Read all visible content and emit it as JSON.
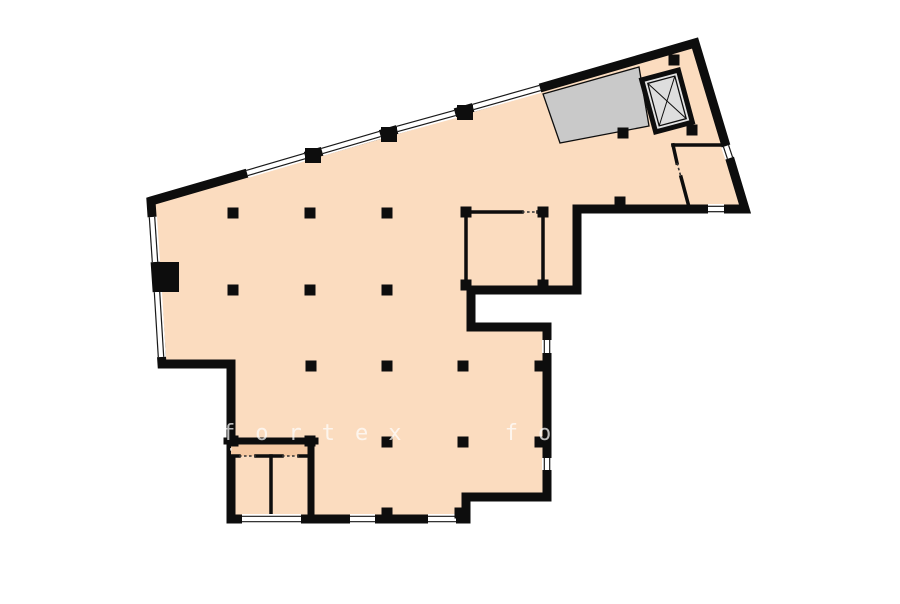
{
  "watermark": {
    "text": "fortex fortex",
    "color": "#ffffff",
    "opacity": 0.72
  },
  "plan": {
    "background_color": "#ffffff",
    "wall_color": "#0d0d0d",
    "floor_color": "#fbdcbf",
    "vestibule_color": "#f5c9a3",
    "stair_color": "#c9c9c9",
    "elevator_fill": "#e3e3e3",
    "elevator_cab_fill": "#dedede",
    "outline_width": 9,
    "outline": [
      [
        151,
        201
      ],
      [
        695,
        43
      ],
      [
        745,
        209
      ],
      [
        577,
        209
      ],
      [
        577,
        290
      ],
      [
        471,
        290
      ],
      [
        471,
        327
      ],
      [
        547,
        327
      ],
      [
        547,
        497
      ],
      [
        466,
        497
      ],
      [
        466,
        519
      ],
      [
        231,
        519
      ],
      [
        231,
        364
      ],
      [
        162,
        364
      ]
    ],
    "windows": [
      [
        247,
        173,
        305,
        156
      ],
      [
        322,
        151,
        380,
        134
      ],
      [
        397,
        129,
        455,
        113
      ],
      [
        473,
        107,
        540,
        88
      ],
      [
        152,
        217,
        155,
        262
      ],
      [
        157,
        292,
        161,
        357
      ],
      [
        242,
        519,
        301,
        519
      ],
      [
        350,
        519,
        375,
        519
      ],
      [
        428,
        519,
        456,
        519
      ],
      [
        547,
        340,
        547,
        353
      ],
      [
        547,
        458,
        547,
        470
      ],
      [
        708,
        209,
        724,
        209
      ],
      [
        726,
        146,
        730,
        158
      ]
    ],
    "inner_walls": [
      {
        "a": [
          466,
          212
        ],
        "b": [
          466,
          285
        ],
        "w": 3.5
      },
      {
        "a": [
          543,
          212
        ],
        "b": [
          543,
          285
        ],
        "w": 3.5
      },
      {
        "a": [
          466,
          212
        ],
        "b": [
          522,
          212
        ],
        "w": 3.5
      },
      {
        "a": [
          538,
          212
        ],
        "b": [
          543,
          212
        ],
        "w": 3.5
      },
      {
        "a": [
          673,
          145
        ],
        "b": [
          726,
          145
        ],
        "w": 3.5
      },
      {
        "a": [
          673,
          145
        ],
        "b": [
          677,
          163
        ],
        "w": 3.5
      },
      {
        "a": [
          681,
          177
        ],
        "b": [
          689,
          207
        ],
        "w": 3.5
      },
      {
        "a": [
          231,
          456
        ],
        "b": [
          239,
          456
        ],
        "w": 3.5
      },
      {
        "a": [
          256,
          456
        ],
        "b": [
          282,
          456
        ],
        "w": 3.5
      },
      {
        "a": [
          299,
          456
        ],
        "b": [
          311,
          456
        ],
        "w": 3.5
      },
      {
        "a": [
          271,
          456
        ],
        "b": [
          271,
          519
        ],
        "w": 3.5
      },
      {
        "a": [
          227,
          441
        ],
        "b": [
          315,
          441
        ],
        "w": 7
      },
      {
        "a": [
          311,
          441
        ],
        "b": [
          311,
          519
        ],
        "w": 7
      }
    ],
    "door_openings": [
      {
        "seg": [
          522,
          212,
          538,
          212
        ],
        "light": false
      },
      {
        "seg": [
          677,
          163,
          681,
          177
        ],
        "light": false
      },
      {
        "seg": [
          239,
          456,
          256,
          456
        ],
        "light": false
      },
      {
        "seg": [
          282,
          456,
          299,
          456
        ],
        "light": false
      },
      {
        "seg": [
          231,
          443,
          231,
          453
        ],
        "light": true
      }
    ],
    "columns": [
      [
        233,
        213
      ],
      [
        310,
        213
      ],
      [
        387,
        213
      ],
      [
        233,
        290
      ],
      [
        310,
        290
      ],
      [
        387,
        290
      ],
      [
        311,
        366
      ],
      [
        387,
        366
      ],
      [
        463,
        366
      ],
      [
        387,
        442
      ],
      [
        463,
        442
      ],
      [
        540,
        366
      ],
      [
        540,
        442
      ],
      [
        387,
        513
      ],
      [
        460,
        513
      ],
      [
        623,
        133
      ],
      [
        692,
        130
      ],
      [
        620,
        202
      ],
      [
        674,
        60
      ],
      [
        466,
        212
      ],
      [
        543,
        212
      ],
      [
        466,
        285
      ],
      [
        543,
        285
      ],
      [
        233,
        441
      ],
      [
        310,
        441
      ]
    ],
    "column_size": 11,
    "wall_piers": [
      [
        305,
        148,
        16,
        15
      ],
      [
        381,
        127,
        16,
        15
      ],
      [
        457,
        105,
        16,
        15
      ],
      [
        155,
        262,
        24,
        30
      ]
    ],
    "stair_area": [
      [
        543,
        94
      ],
      [
        639,
        67
      ],
      [
        649,
        126
      ],
      [
        560,
        143
      ]
    ],
    "vestibule_rect": [
      231,
      444,
      77,
      12
    ],
    "elevator": {
      "cx": 667,
      "cy": 101,
      "w": 38,
      "h": 54,
      "angle": -15,
      "inset": 5
    }
  }
}
